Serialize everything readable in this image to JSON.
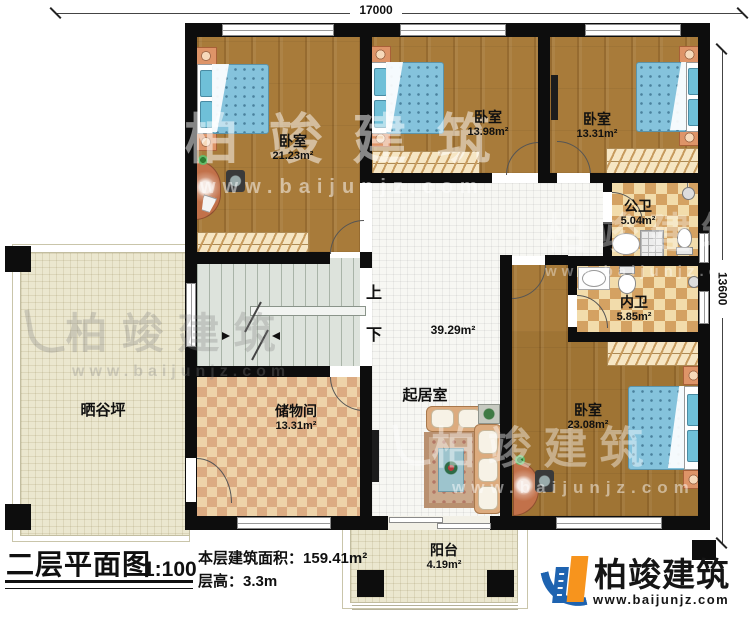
{
  "title_block": {
    "title": "二层平面图",
    "scale": "1:100",
    "area_label": "本层建筑面积：",
    "area_value": "159.41m²",
    "height_label": "层高：",
    "height_value": "3.3m"
  },
  "branding": {
    "company": "柏竣建筑",
    "website": "www.baijunjz.com"
  },
  "watermark": {
    "company": "柏竣建筑",
    "website": "www.baijunjz.com"
  },
  "dimensions": {
    "top": "17000",
    "right": "13600"
  },
  "stairs": {
    "up_label": "上",
    "down_label": "下"
  },
  "rooms": {
    "bedroom_top_left": {
      "name": "卧室",
      "area": "21.23m²"
    },
    "bedroom_top_mid": {
      "name": "卧室",
      "area": "13.98m²"
    },
    "bedroom_top_right": {
      "name": "卧室",
      "area": "13.31m²"
    },
    "public_bath": {
      "name": "公卫",
      "area": "5.04m²"
    },
    "ensuite_bath": {
      "name": "内卫",
      "area": "5.85m²"
    },
    "bedroom_right": {
      "name": "卧室",
      "area": "23.08m²"
    },
    "living_room": {
      "name": "起居室",
      "area": "39.29m²"
    },
    "storage": {
      "name": "储物间",
      "area": "13.31m²"
    },
    "drying_terrace": {
      "name": "晒谷坪"
    },
    "balcony": {
      "name": "阳台",
      "area": "4.19m²"
    }
  },
  "colors": {
    "wall": "#0d0d0d",
    "wood_floor": "#a87b3a",
    "bath_tile": "#d9a96b",
    "storage_tile": "#d8a47e",
    "terrace": "#ebe7cf",
    "stairs": "#dde3dc",
    "bed_blue": "#85c3dc",
    "logo_blue": "#1e63b0",
    "logo_orange": "#f7941d"
  }
}
